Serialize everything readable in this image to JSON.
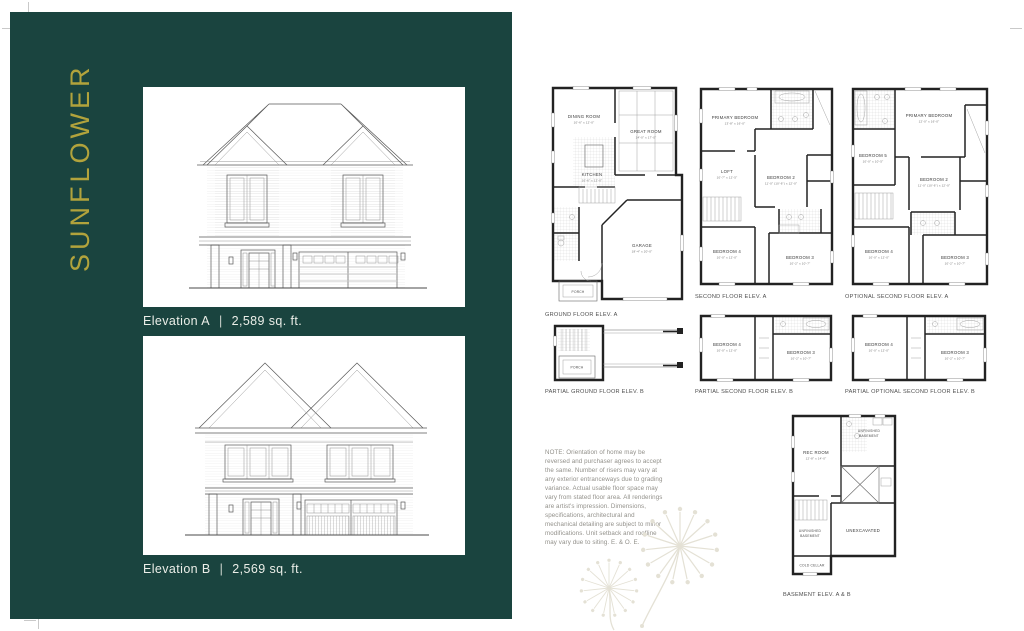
{
  "colors": {
    "panel_teal": "#1a443f",
    "gold": "#b2a33c",
    "decor": "#e4e1d5"
  },
  "panel": {
    "model_name": "SUNFLOWER",
    "divider": "|",
    "elevations": [
      {
        "label": "Elevation A",
        "sqft": "2,589 sq. ft."
      },
      {
        "label": "Elevation B",
        "sqft": "2,569 sq. ft."
      }
    ]
  },
  "floorplans": {
    "ground_a": {
      "caption": "GROUND FLOOR ELEV. A",
      "labels": {
        "dining": "DINING ROOM",
        "dining_dim": "10'-6\" x 12'-0\"",
        "great": "GREAT ROOM",
        "great_dim": "14'-0\" x 17'-0\"",
        "kitchen": "KITCHEN",
        "kitchen_dim": "10'-6\" x 12'-0\"",
        "garage": "GARAGE",
        "garage_dim": "18'-4\" x 20'-0\"",
        "porch": "PORCH"
      }
    },
    "second_a": {
      "caption": "SECOND FLOOR ELEV. A",
      "labels": {
        "primary": "PRIMARY BEDROOM",
        "primary_dim": "13'-8\" x 16'-0\"",
        "loft": "LOFT",
        "loft_dim": "10'-7\" x 12'-5\"",
        "bed2": "BEDROOM 2",
        "bed2_dim": "11'-0\" (10'-6\") x 12'-0\"",
        "bed3": "BEDROOM 3",
        "bed3_dim": "10'-2\" x 10'-7\"",
        "bed4": "BEDROOM 4",
        "bed4_dim": "10'-0\" x 12'-0\""
      }
    },
    "optional_a": {
      "caption": "OPTIONAL SECOND FLOOR ELEV. A",
      "labels": {
        "primary": "PRIMARY BEDROOM",
        "primary_dim": "12'-0\" x 16'-0\"",
        "bed5": "BEDROOM 5",
        "bed5_dim": "10'-0\" x 10'-5\"",
        "bed2": "BEDROOM 2",
        "bed2_dim": "11'-0\" (10'-6\") x 12'-0\"",
        "bed3": "BEDROOM 3",
        "bed3_dim": "10'-2\" x 10'-7\"",
        "bed4": "BEDROOM 4",
        "bed4_dim": "10'-0\" x 12'-0\""
      }
    },
    "partial_ground_b": {
      "caption": "PARTIAL GROUND FLOOR ELEV. B",
      "labels": {
        "porch": "PORCH"
      }
    },
    "partial_second_b": {
      "caption": "PARTIAL SECOND FLOOR ELEV. B",
      "labels": {
        "bed4": "BEDROOM 4",
        "bed4_dim": "10'-0\" x 12'-0\"",
        "bed3": "BEDROOM 3",
        "bed3_dim": "10'-2\" x 10'-7\""
      }
    },
    "partial_optional_b": {
      "caption": "PARTIAL OPTIONAL SECOND FLOOR ELEV. B",
      "labels": {
        "bed4": "BEDROOM 4",
        "bed4_dim": "10'-0\" x 12'-0\"",
        "bed3": "BEDROOM 3",
        "bed3_dim": "10'-2\" x 10'-7\""
      }
    },
    "basement": {
      "caption": "BASEMENT ELEV. A & B",
      "labels": {
        "rec": "REC ROOM",
        "rec_dim": "12'-8\" x 14'-0\"",
        "unfinished_a1": "UNFINISHED",
        "unfinished_a2": "BASEMENT",
        "unexcavated": "UNEXCAVATED",
        "unfinished_b1": "UNFINISHED",
        "unfinished_b2": "BASEMENT",
        "cold_cellar": "COLD CELLAR"
      }
    }
  },
  "note": {
    "text": "NOTE: Orientation of home may be reversed and purchaser agrees to accept the same. Number of risers may vary at any exterior entranceways due to grading variance. Actual usable floor space may vary from stated floor area. All renderings are artist's impression. Dimensions, specifications, architectural and mechanical detailing are subject to minor modifications. Unit setback and roofline may vary due to siting. E. & O. E."
  }
}
